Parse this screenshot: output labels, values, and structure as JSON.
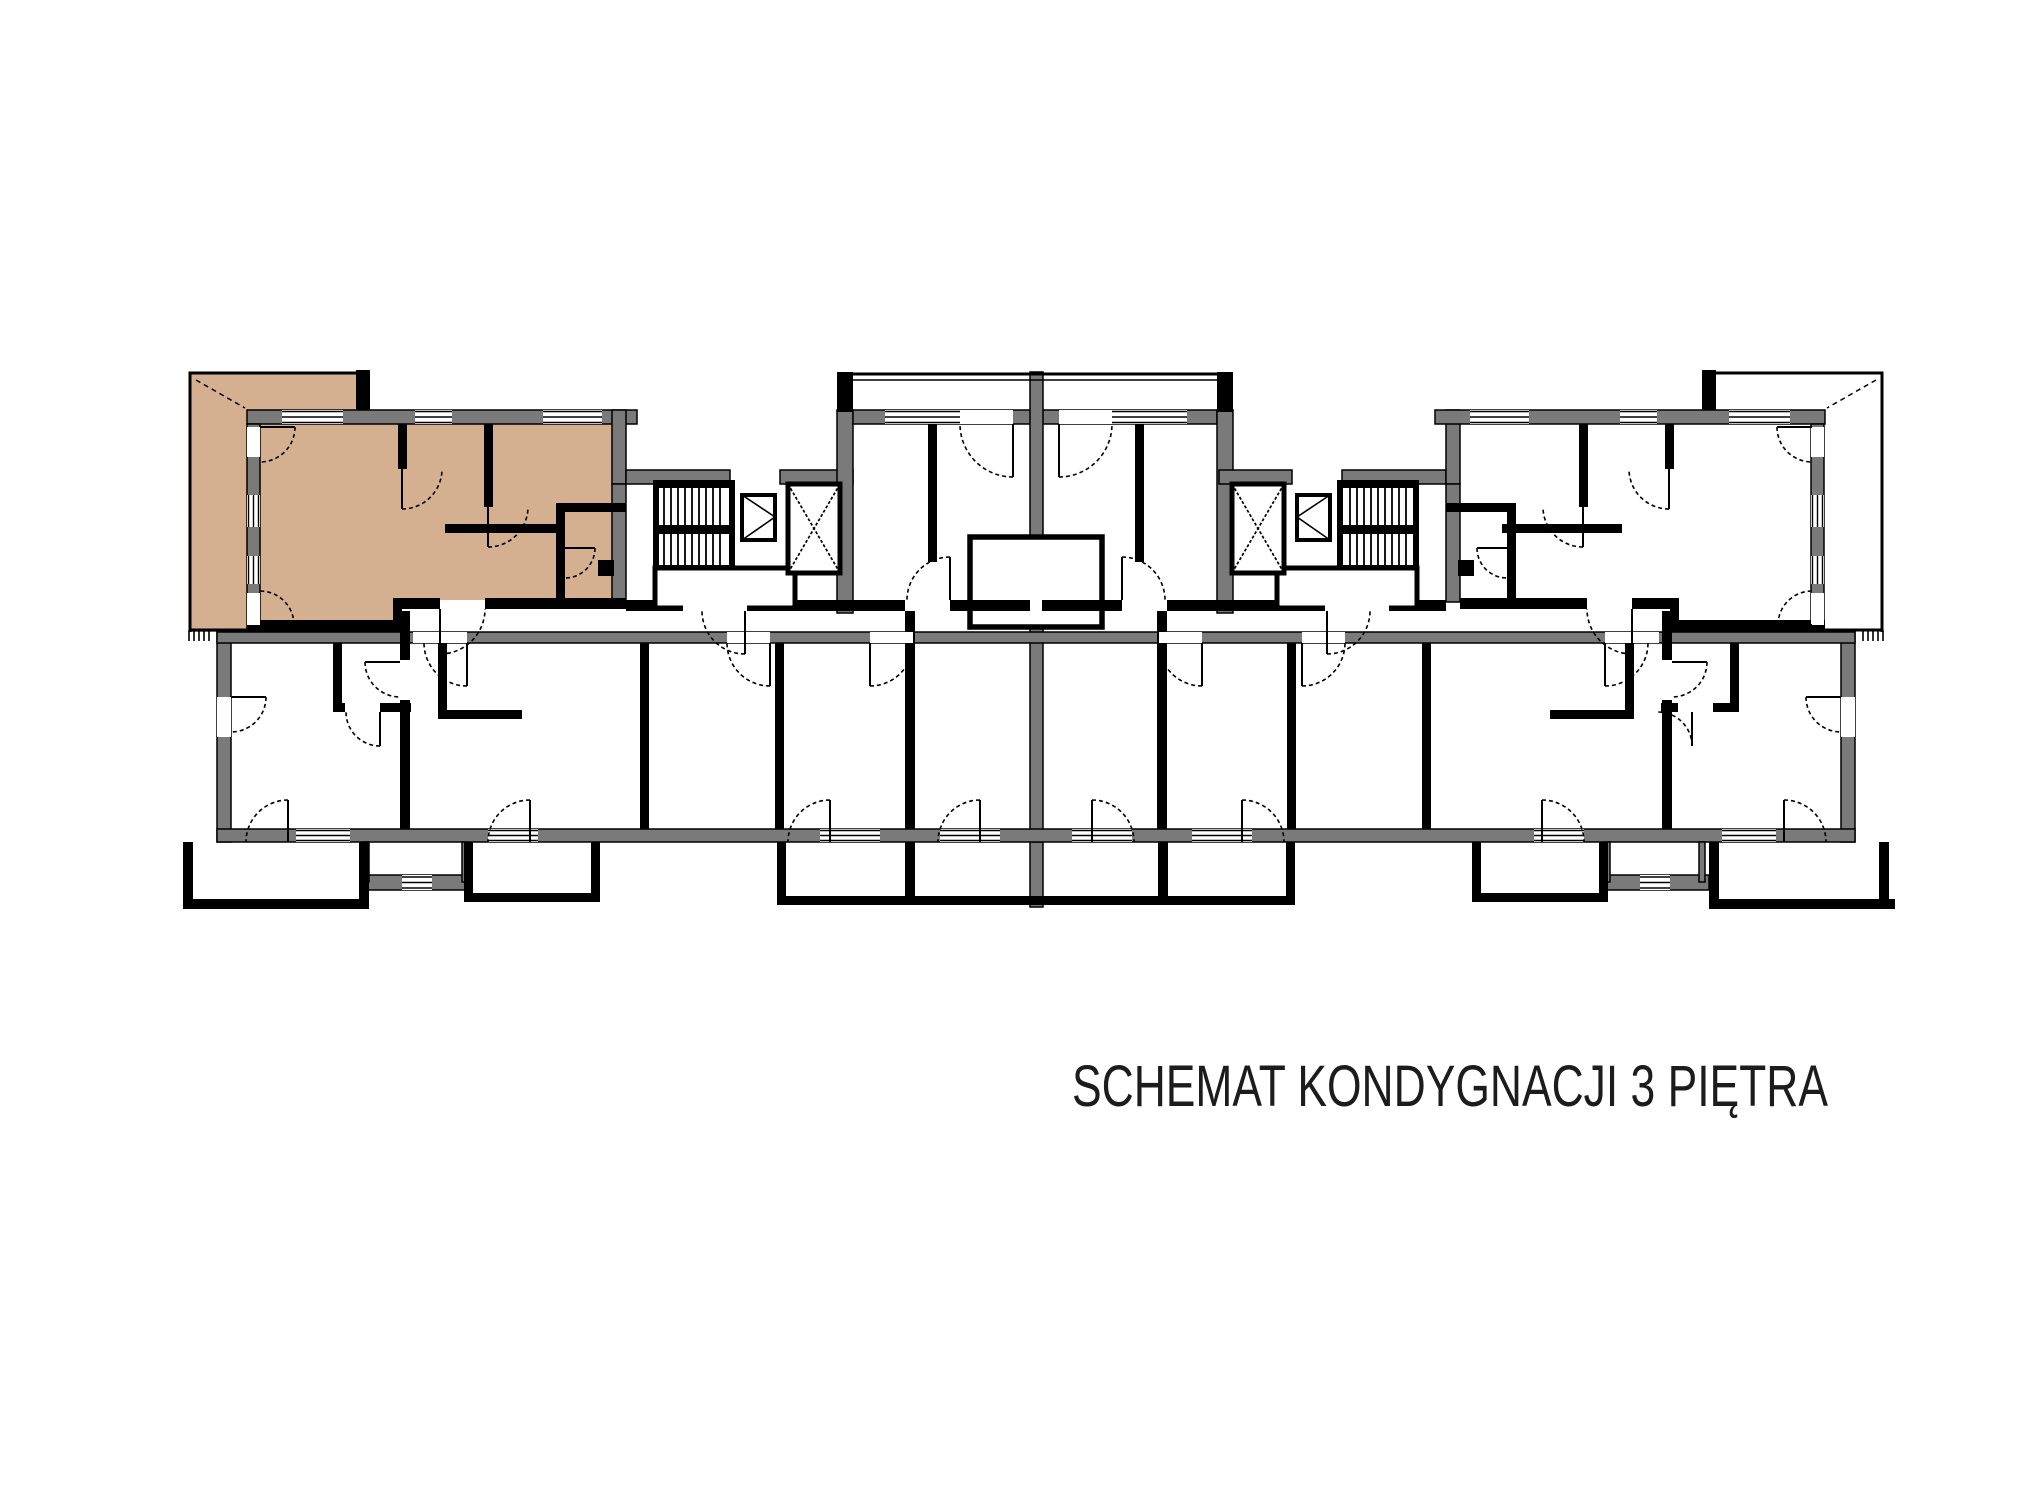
{
  "title": {
    "text": "SCHEMAT KONDYGNACJI 3 PIĘTRA"
  },
  "plan": {
    "floor_number": "3",
    "highlighted_unit": {
      "location": "top-left",
      "includes_balcony": true,
      "fill": "#d4b090"
    },
    "colors": {
      "highlight": "#d4b090",
      "exterior_wall": "#7a7a7a",
      "line": "#000000",
      "background": "#ffffff",
      "title_text": "#1c1c1c"
    },
    "elements": {
      "staircases": 2,
      "elevators": 2,
      "top_balconies": 4,
      "bottom_balconies": 8
    }
  }
}
